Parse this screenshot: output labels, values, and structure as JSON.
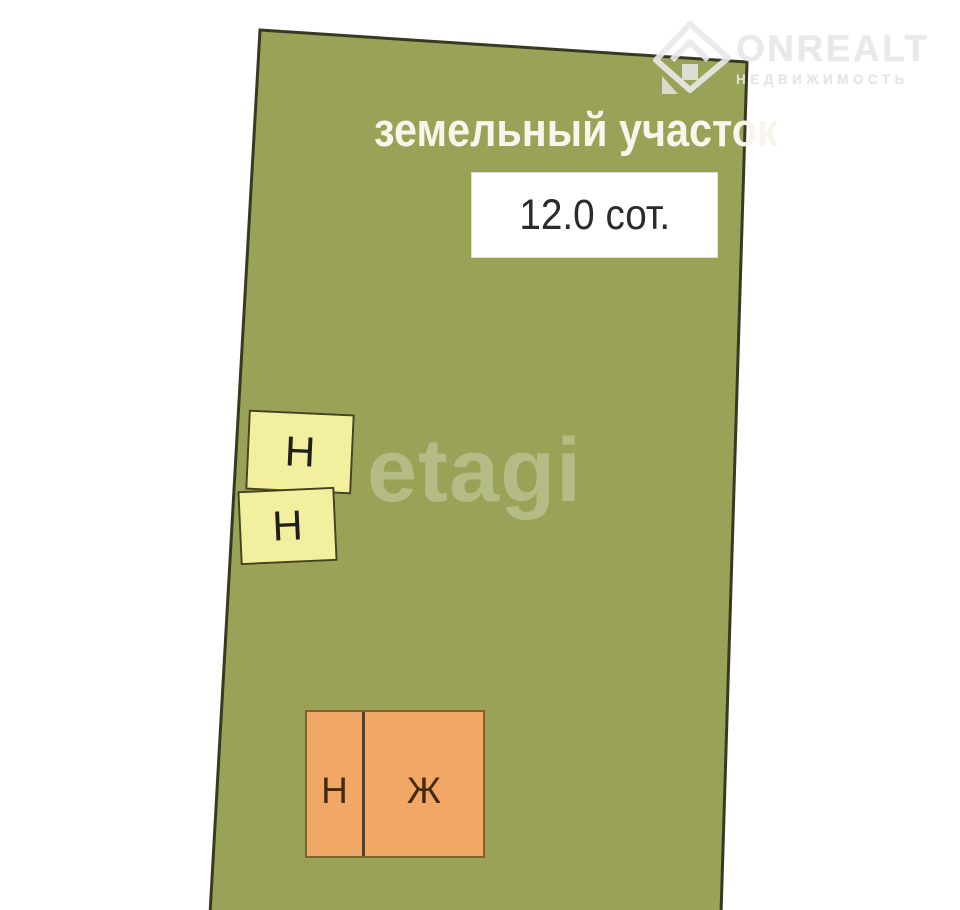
{
  "page": {
    "background": "#ffffff"
  },
  "parcel": {
    "title": "земельный участок",
    "area_label": "12.0 сот.",
    "fill": "#99a257",
    "border_color": "#373a20"
  },
  "watermark": {
    "text": "etagi",
    "color": "rgba(255,255,255,0.27)"
  },
  "brand": {
    "name": "ONREALT",
    "tagline": "НЕДВИЖИМОСТЬ",
    "icon": "house-magnifier-icon",
    "color": "#e9e9e9"
  },
  "buildings": {
    "outbuilding_upper": {
      "label": "Н",
      "fill": "#f2f09f",
      "border": "#45431f"
    },
    "outbuilding_lower": {
      "label": "Н",
      "fill": "#f2f09f",
      "border": "#45431f"
    },
    "house_left": {
      "label": "Н",
      "fill": "#f1a866",
      "border": "#7d6332"
    },
    "house_right": {
      "label": "Ж",
      "fill": "#f1a866",
      "border": "#7d6332"
    }
  }
}
